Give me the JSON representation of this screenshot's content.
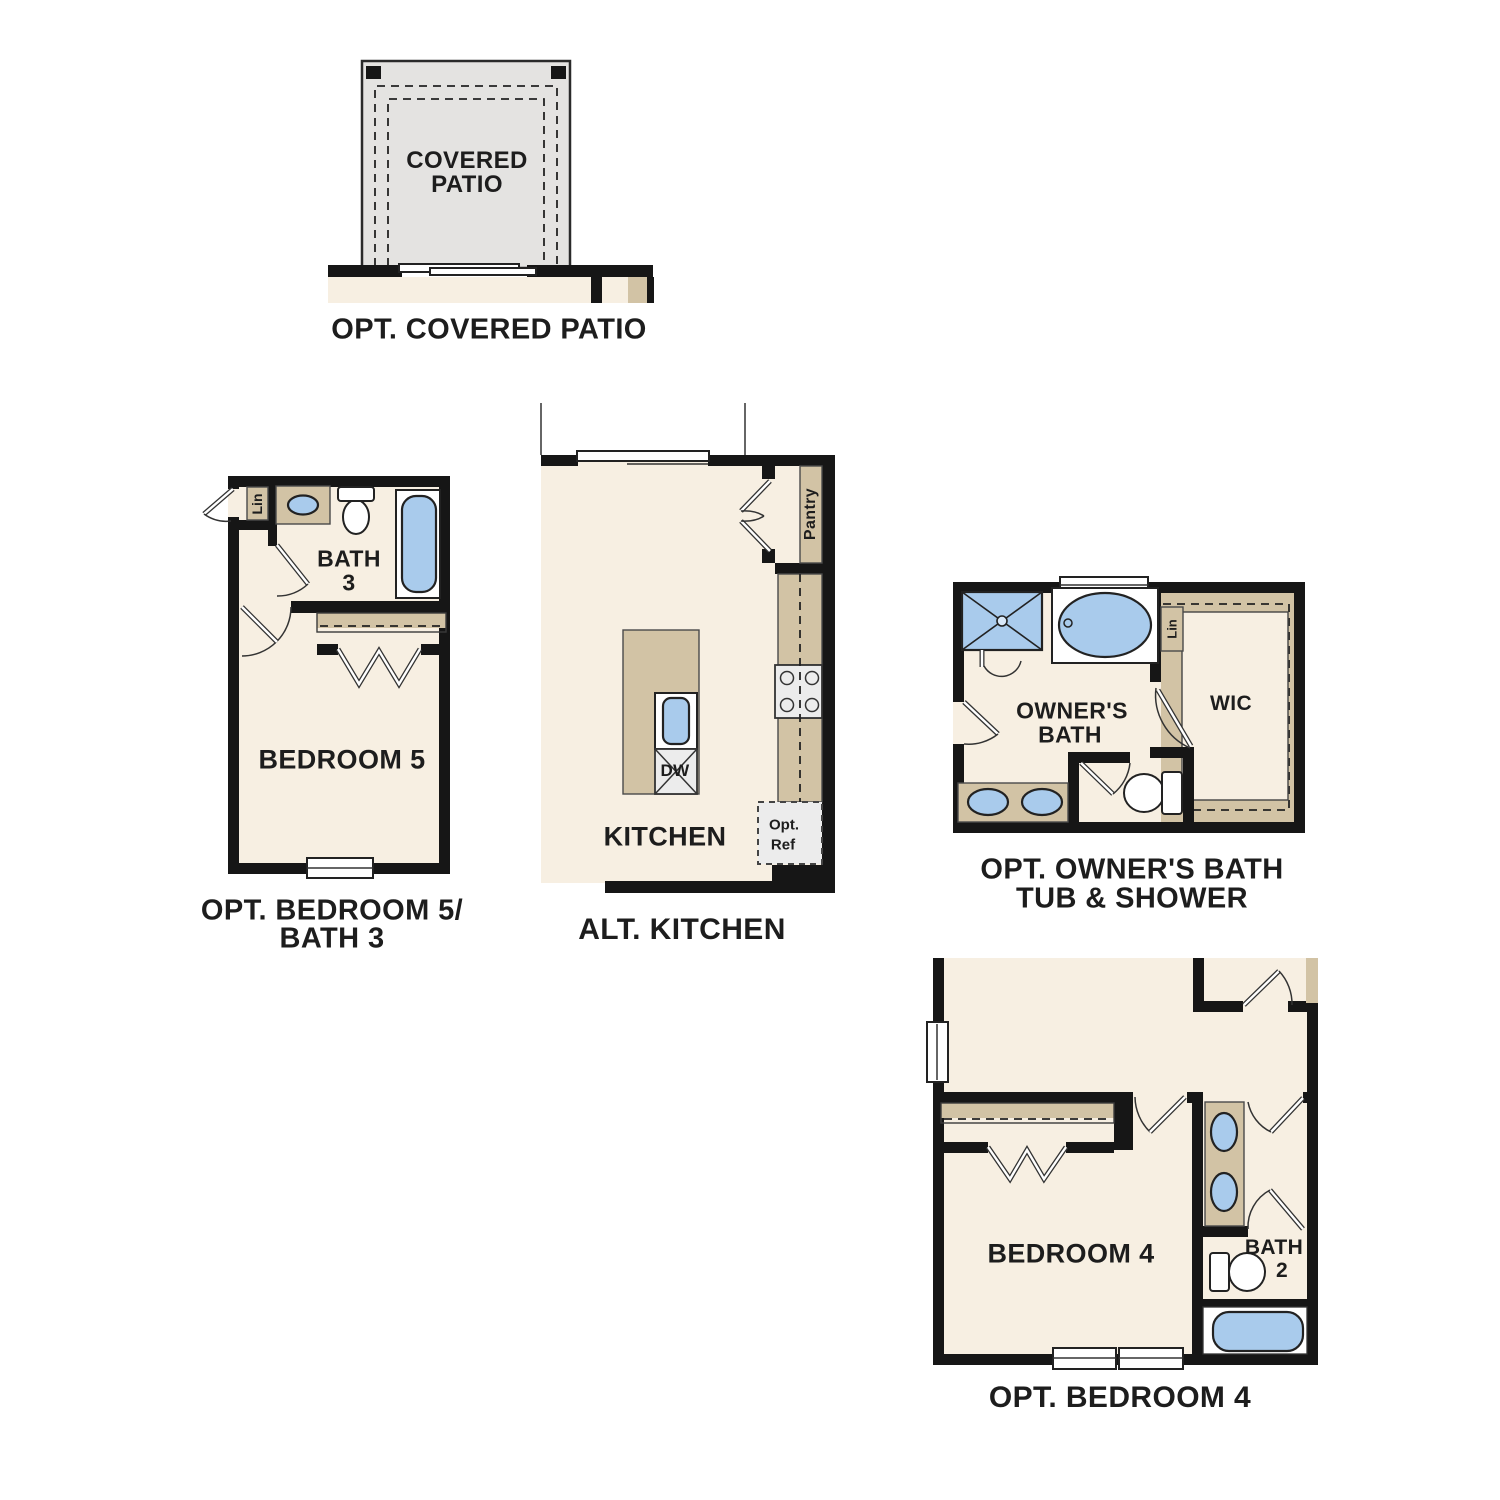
{
  "colors": {
    "wall": "#161616",
    "room_fill": "#f7efe2",
    "cabinet_tan": "#d2c3a5",
    "fixture_blue": "#a9cbec",
    "patio_gray": "#e4e3e1",
    "appliance_gray": "#ececec",
    "label_text": "#1d1d1d"
  },
  "plans": {
    "covered_patio": {
      "room_label_line1": "COVERED",
      "room_label_line2": "PATIO",
      "caption": "OPT. COVERED PATIO"
    },
    "bedroom5_bath3": {
      "bath_label_line1": "BATH",
      "bath_label_line2": "3",
      "linen_label": "Lin",
      "bedroom_label": "BEDROOM 5",
      "caption_line1": "OPT. BEDROOM 5/",
      "caption_line2": "BATH 3"
    },
    "alt_kitchen": {
      "room_label": "KITCHEN",
      "pantry_label": "Pantry",
      "dishwasher_label": "DW",
      "opt_ref_line1": "Opt.",
      "opt_ref_line2": "Ref",
      "caption": "ALT. KITCHEN"
    },
    "owners_bath": {
      "room_label_line1": "OWNER'S",
      "room_label_line2": "BATH",
      "wic_label": "WIC",
      "linen_label": "Lin",
      "caption_line1": "OPT. OWNER'S BATH",
      "caption_line2": "TUB & SHOWER"
    },
    "bedroom4": {
      "room_label": "BEDROOM 4",
      "bath_label_line1": "BATH",
      "bath_label_line2": "2",
      "caption": "OPT. BEDROOM 4"
    }
  }
}
